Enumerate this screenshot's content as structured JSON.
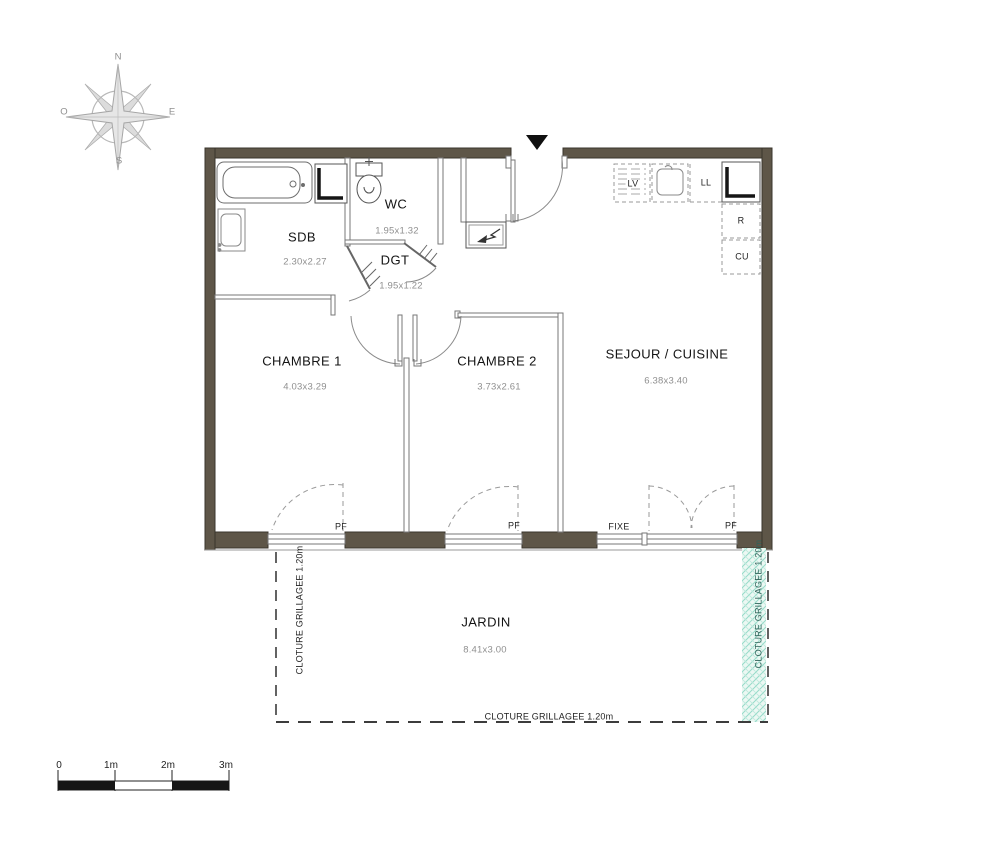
{
  "plan": {
    "rooms": [
      {
        "name": "SDB",
        "dims": "2.30x2.27"
      },
      {
        "name": "WC",
        "dims": "1.95x1.32"
      },
      {
        "name": "DGT",
        "dims": "1.95x1.22"
      },
      {
        "name": "CHAMBRE 1",
        "dims": "4.03x3.29"
      },
      {
        "name": "CHAMBRE 2",
        "dims": "3.73x2.61"
      },
      {
        "name": "SEJOUR / CUISINE",
        "dims": "6.38x3.40"
      },
      {
        "name": "JARDIN",
        "dims": "8.41x3.00"
      }
    ],
    "appliances": {
      "dishwasher": "LV",
      "washing_machine": "LL",
      "fridge": "R",
      "cooker": "CU"
    },
    "openings": {
      "pf_chambre1": "PF",
      "pf_chambre2": "PF",
      "fixed_window": "FIXE",
      "pf_sejour": "PF"
    },
    "fence": {
      "left": "CLOTURE GRILLAGEE 1.20m",
      "right": "CLOTURE GRILLAGEE 1.20m",
      "bottom": "CLOTURE GRILLAGEE 1.20m"
    }
  },
  "compass": {
    "north": "N",
    "east": "E",
    "south": "S",
    "west": "O"
  },
  "scale_bar": {
    "labels": [
      "0",
      "1m",
      "2m",
      "3m"
    ]
  },
  "colors": {
    "wall": "#5e5648",
    "wall_edge": "#3a352c",
    "fence_green_bg": "#ecf8f3",
    "fence_green_line": "#96dbc9",
    "fence_text": "#31635a"
  }
}
